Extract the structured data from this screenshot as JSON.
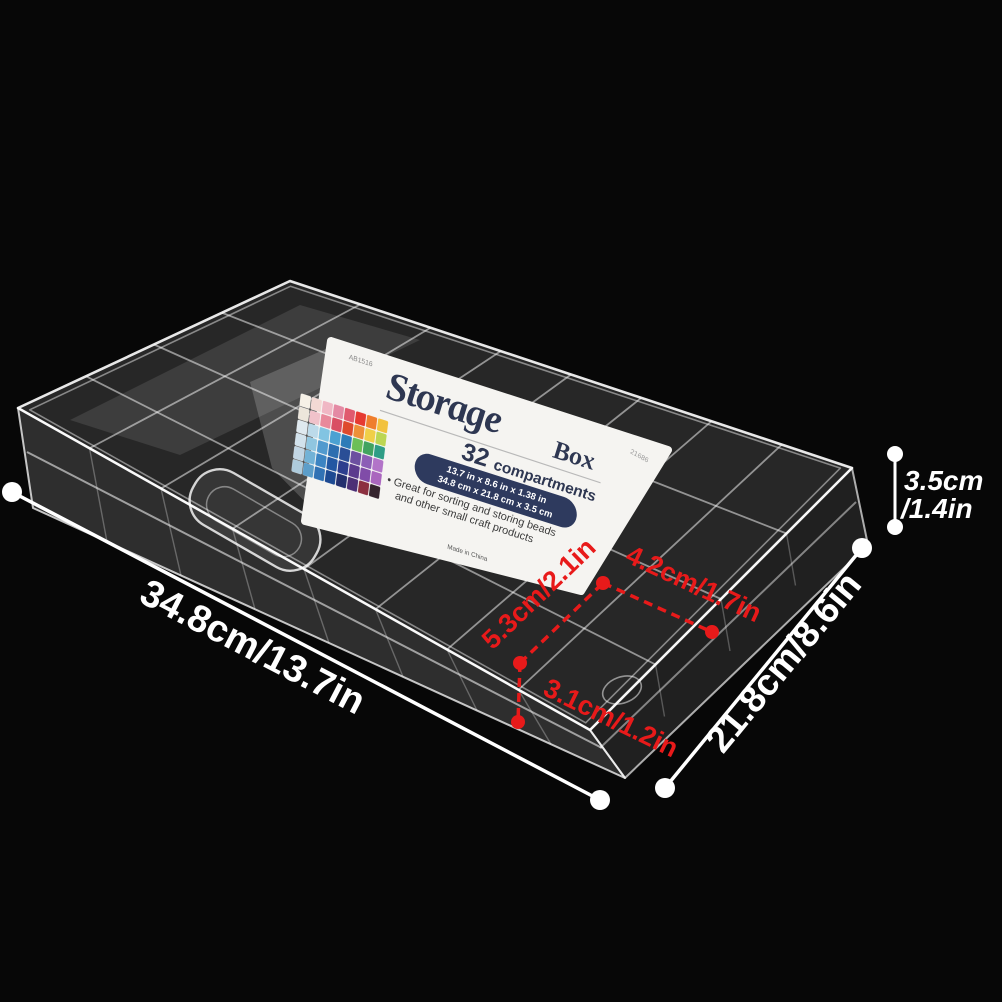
{
  "colors": {
    "background": "#070707",
    "annotation_white": "#ffffff",
    "annotation_red": "#e81a1a",
    "label_navy": "#2e3a5e",
    "plastic_edge": "rgba(255,255,255,0.9)"
  },
  "measurements": {
    "length": "34.8cm/13.7in",
    "width": "21.8cm/8.6in",
    "height_line1": "3.5cm",
    "height_line2": "/1.4in",
    "cell_depth": "5.3cm/2.1in",
    "cell_width": "4.2cm/1.7in",
    "cell_height": "3.1cm/1.2in"
  },
  "label": {
    "sku": "AB1516",
    "item_number": "21686",
    "title": "Storage",
    "title_suffix": "Box",
    "compartments_number": "32",
    "compartments_word": "compartments",
    "size_inches": "13.7 in x 8.6 in x 1.38 in",
    "size_cm": "34.8 cm x 21.8 cm x 3.5 cm",
    "bullet_line1": "• Great for sorting and storing beads",
    "bullet_line2": "and other small craft products",
    "origin": "Made in China",
    "photo_palette": [
      "#f6f1e7",
      "#f3d9d4",
      "#f0b7c4",
      "#e48aa4",
      "#e05a6e",
      "#e63a31",
      "#ef7e2c",
      "#f2c23e",
      "#ece6db",
      "#f0c2ca",
      "#e8899b",
      "#d94f63",
      "#de4a2d",
      "#ed9038",
      "#f0cf48",
      "#bcd653",
      "#dfe9ef",
      "#bcdaea",
      "#82c4e2",
      "#4ba1d2",
      "#2e7cb8",
      "#6cbf58",
      "#41a360",
      "#2f9d86",
      "#d2e2ec",
      "#90c6e0",
      "#529ace",
      "#2d6eb0",
      "#2a4e96",
      "#6c50a0",
      "#8c5eb6",
      "#b274c8",
      "#c2d6e4",
      "#72b2d6",
      "#3c84c2",
      "#2257a2",
      "#2c3e8e",
      "#5b3b8e",
      "#804ca8",
      "#aa66be",
      "#aecbdc",
      "#5c9eca",
      "#3172b4",
      "#1d4a92",
      "#24306e",
      "#4c3076",
      "#8c3040",
      "#35242e"
    ]
  }
}
